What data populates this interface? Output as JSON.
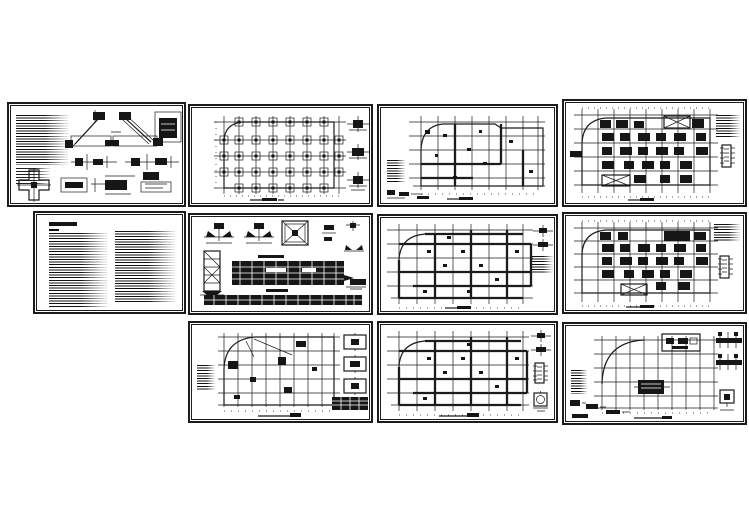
{
  "page": {
    "background_color": "#ffffff",
    "paper_color": "#ffffff",
    "ink_color": "#1c1c1c",
    "content": "Collage of 11 black-and-white CAD structural drawing sheets arranged in three rows (4 / 4 / 3)",
    "legible_text": ""
  },
  "layout_hint": {
    "rows": 3,
    "sheets_per_row": [
      4,
      4,
      3
    ]
  },
  "sheets": [
    {
      "id": "sheet-01",
      "kind": "structural-details",
      "description": "Structural details sheet: two hatched stair flight sections, beam-column connection details, cross-shaped column section at lower left, dense notes column at left"
    },
    {
      "id": "sheet-02",
      "kind": "foundation-plan",
      "description": "Footing foundation layout plan: column grid with square pad footings at intersections, rounded top-left building outline, three pile-cap details at right, title mark below"
    },
    {
      "id": "sheet-03",
      "kind": "floor-framing-plan",
      "description": "Floor framing plan with rounded corner outline on column grid, small notes block at left and small details at lower left"
    },
    {
      "id": "sheet-04",
      "kind": "slab-reinforcement-plan",
      "description": "Dense slab reinforcement plan: many filled panels, two crossed openings, notes block and ladder-like schedule detail at right"
    },
    {
      "id": "sheet-05",
      "kind": "general-notes",
      "description": "General structural design notes sheet: bold title at top left and two columns of dense specification text"
    },
    {
      "id": "sheet-06",
      "kind": "pile-details-and-schedules",
      "description": "Pile details sheet: pile elevation at left, cap details and crossed square cap plan at top, two dark schedule tables, small detail at lower right"
    },
    {
      "id": "sheet-07",
      "kind": "beam-framing-plan",
      "description": "Beam framing plan: thick beam lines on column grid with rounded corner, cap details and notes block at right"
    },
    {
      "id": "sheet-08",
      "kind": "slab-reinforcement-plan",
      "description": "Dense slab reinforcement plan with crossed opening near lower left, notes cluster and ladder-like schedule detail at right"
    },
    {
      "id": "sheet-09",
      "kind": "roof-framing-plan",
      "description": "Roof framing plan: sparse grid with curved corner and diagonal, three section details and dark table at right, notes block at left"
    },
    {
      "id": "sheet-10",
      "kind": "beam-framing-plan",
      "description": "Beam framing plan: thick beams on grid, cap details, ladder schedule block and round detail at right"
    },
    {
      "id": "sheet-11",
      "kind": "upper-roof-plan",
      "description": "Upper roof plan: mostly bare column grid with large quarter-arc corner, rooftop stair rectangle at top, dark machine-room detail at centre, small details at bottom left and right"
    }
  ]
}
